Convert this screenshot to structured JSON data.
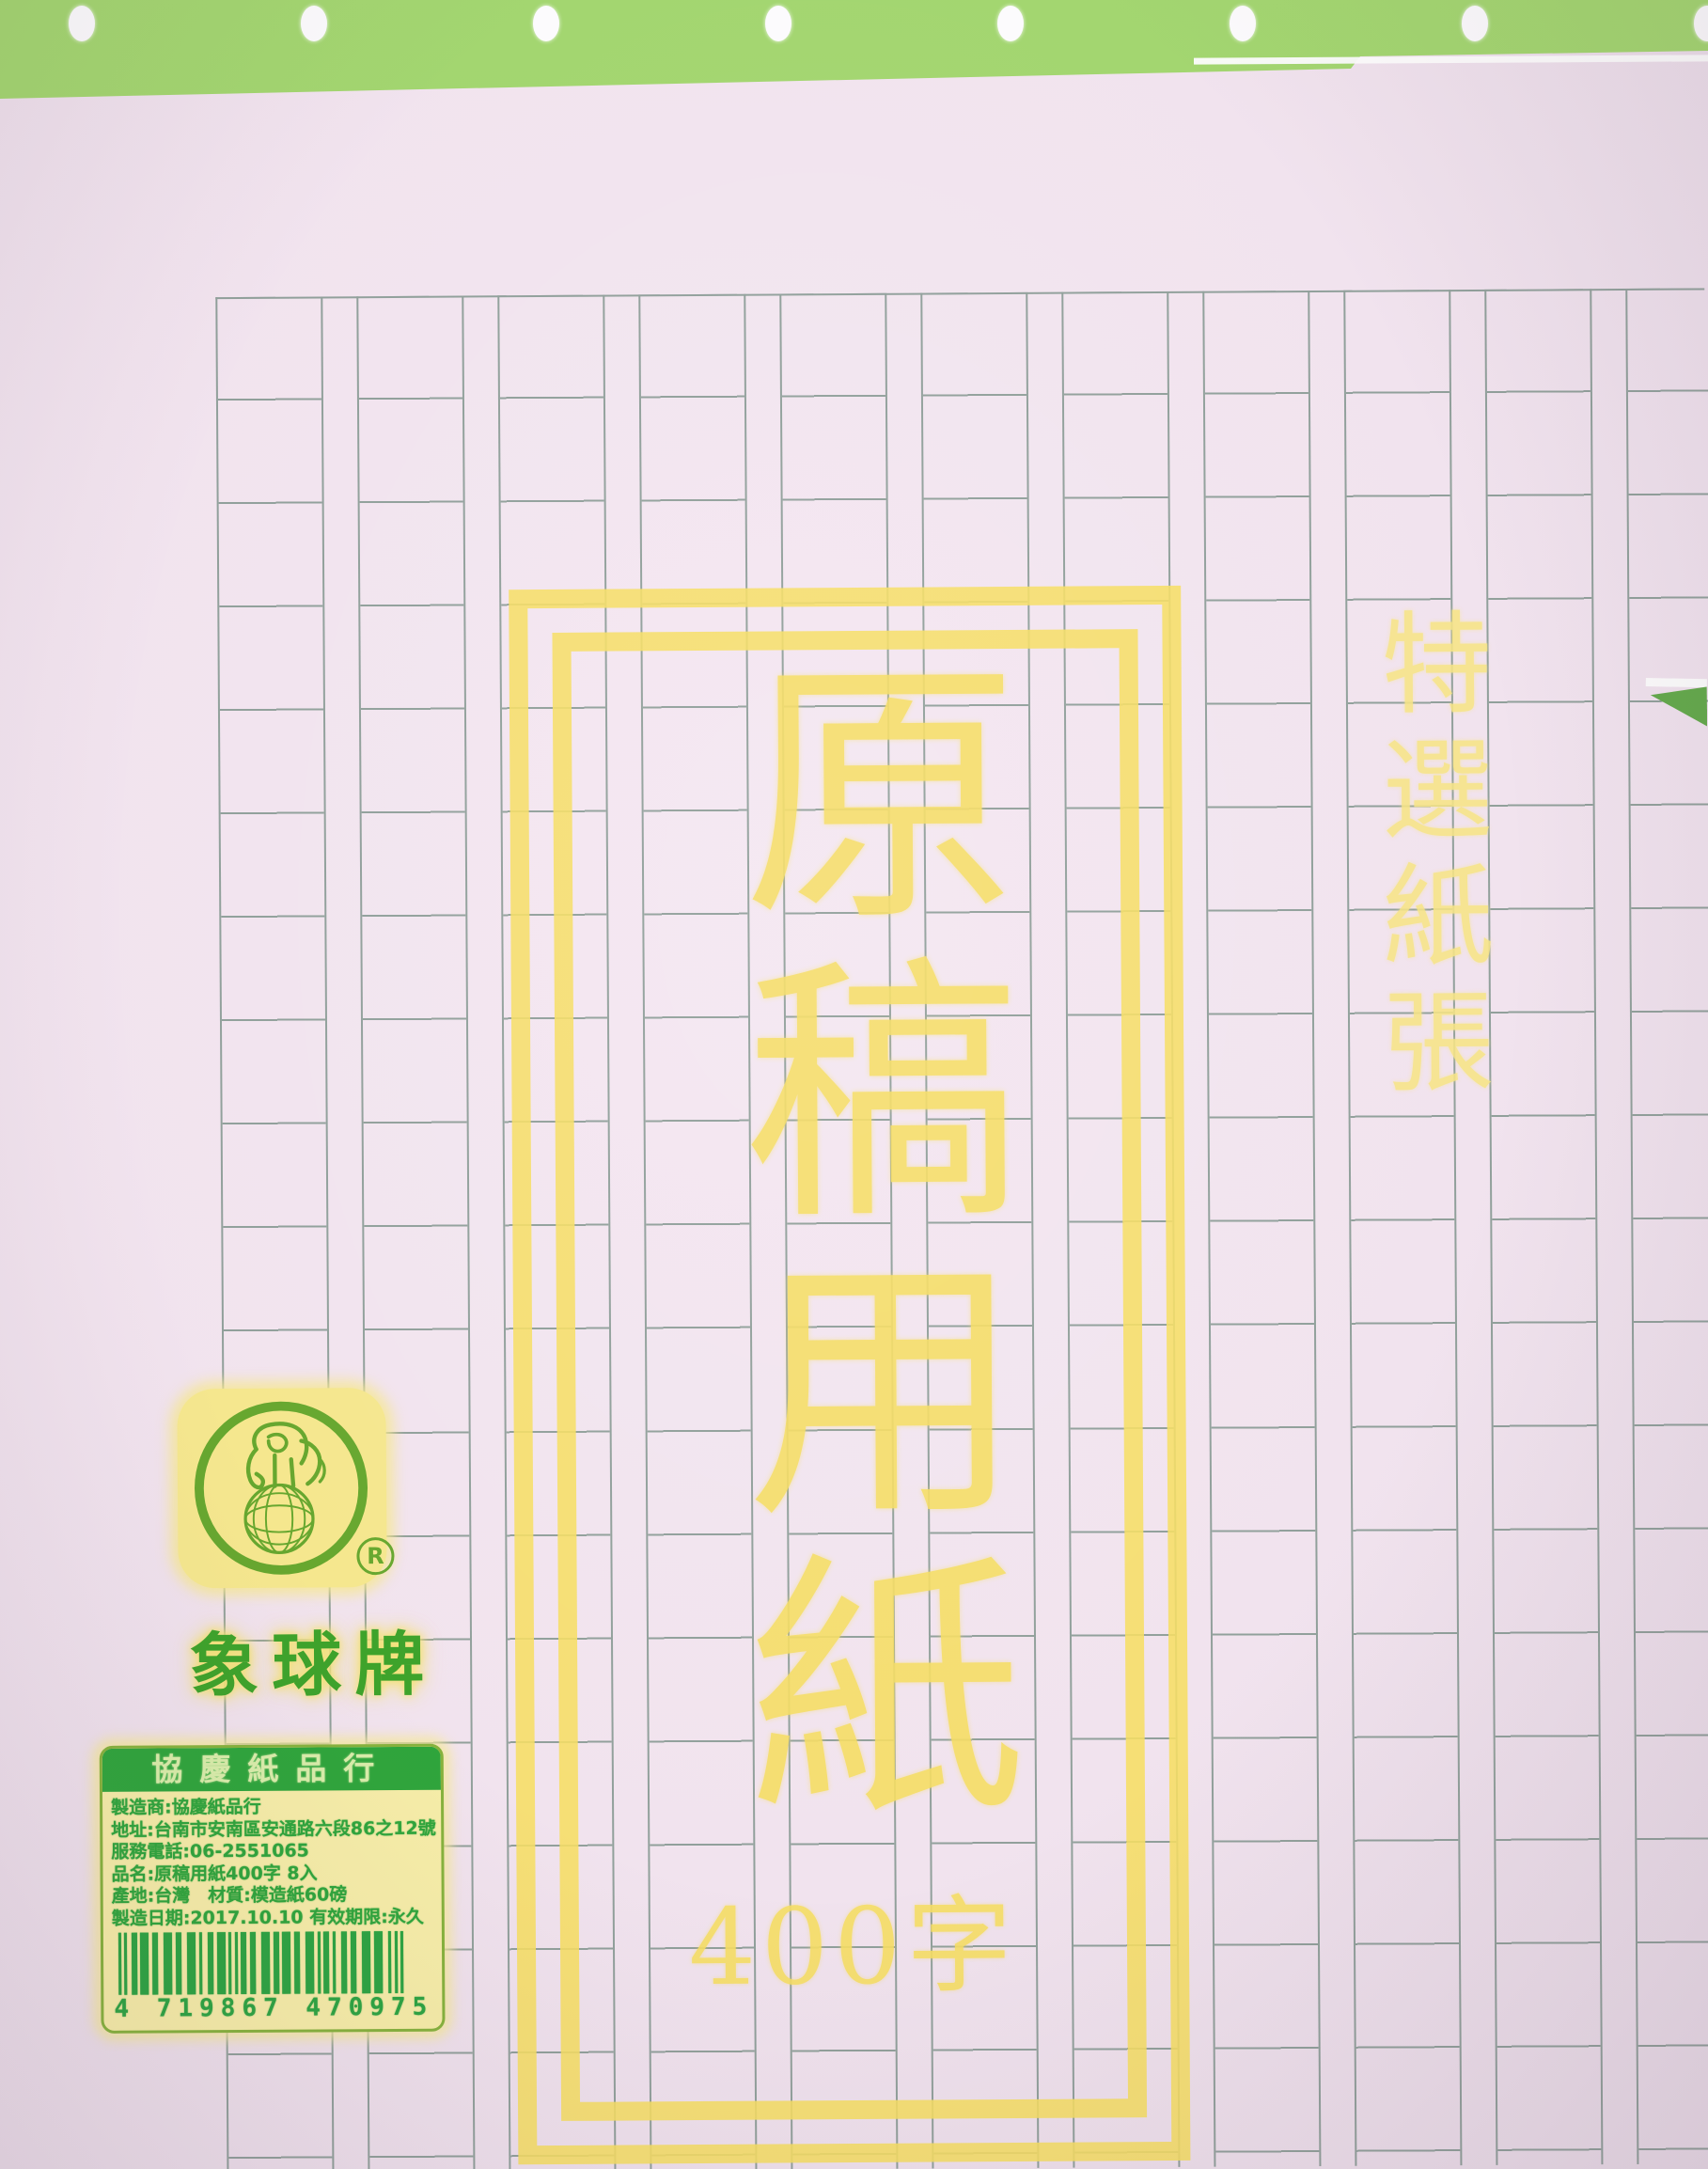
{
  "title": {
    "vertical_text": "原稿用紙",
    "count_text": "400字"
  },
  "side_text": "特選紙張",
  "brand": {
    "name": "象球牌",
    "registered_mark": "R"
  },
  "label": {
    "header": "協慶紙品行",
    "lines": [
      "製造商:協慶紙品行",
      "地址:台南市安南區安通路六段86之12號",
      "服務電話:06-2551065",
      "品名:原稿用紙400字 8入",
      "產地:台灣　材質:模造紙60磅",
      "製造日期:2017.10.10 有效期限:永久"
    ],
    "barcode_digits": "4719867470975",
    "barcode_display": "4 719867 470975"
  },
  "colors": {
    "pegboard-green": "#a3d670",
    "paper-pink": "#f1e3ee",
    "grid-line": "#91a09b",
    "print-yellow": "#f6de64",
    "print-yellow-light": "#f7e586",
    "label-bg": "#f6eda8",
    "label-green": "#2fa53c",
    "label-border": "#86b23d",
    "barcode-green": "#2da442",
    "logo-green": "#67a72f",
    "brand-green": "#3ea32b"
  }
}
